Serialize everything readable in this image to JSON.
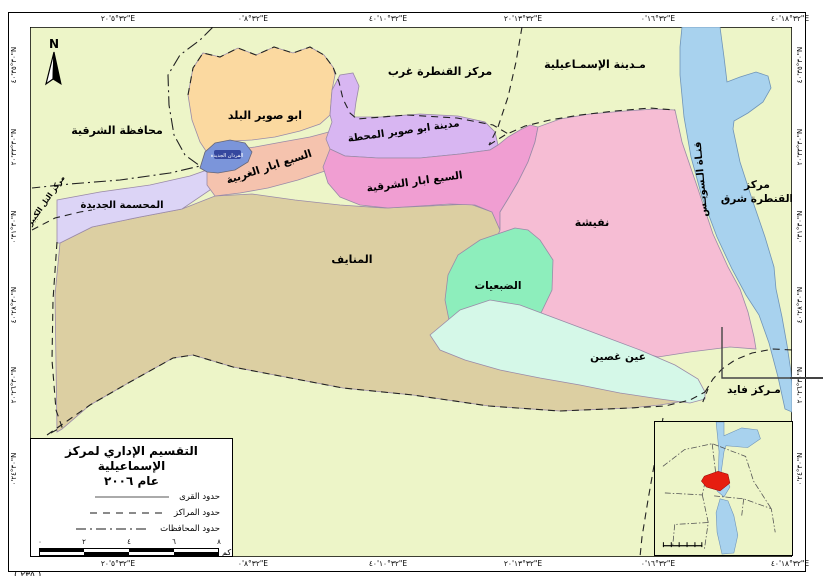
{
  "frame": {
    "north_label": "N",
    "caption_fragment": "( ٢٣٥ )"
  },
  "coords": {
    "lon": [
      "٣٢°٥'٢٠\"E",
      "٣٢°٨'٠\"E",
      "٣٢°١٠'٤٠\"E",
      "٣٢°١٣'٢٠\"E",
      "٣٢°١٦'٠\"E",
      "٣٢°١٨'٤٠\"E"
    ],
    "lat": [
      "٣٠°٣٥'٤٠\"N",
      "٣٠°٣٣'٢٠\"N",
      "٣٠°٣١'٠\"N",
      "٣٠°٢٨'٤٠\"N",
      "٣٠°٢٦'٢٠\"N",
      "٣٠°٢٤'٠\"N"
    ]
  },
  "regions": {
    "abu_suwair_balad": "ابو صوير البلد",
    "abu_suwair_mahatta": "مدينة ابو صوير المحطة",
    "sabaa_abar_gharbia": "السبع ابار الغربية",
    "sabaa_abar_sharqia": "السبع ابار الشرقية",
    "ferdan_gedida": "الفردان الجديدة",
    "mahsama_gedida": "المحسمة الجديدة",
    "manayef": "المنايف",
    "nefisha": "نفيشة",
    "dabaiyat": "الضبعيات",
    "ain_ghosein": "عين غصين",
    "suez_canal": "قنـاة الـسويـس"
  },
  "neighbors": {
    "sharqia_gov": "محافظة الشرقية",
    "qantara_gharb": "مركز القنطرة غرب",
    "ismailia_city": "مـدينة الإسمـاعيلية",
    "qantara_sharq_line1": "مركز",
    "qantara_sharq_line2": "القنطرة شرق",
    "fayed": "مـركز فايد",
    "tell_kebir": "مركز التل الكبير"
  },
  "legend_box": {
    "title_line1": "التقسيم الإداري لمركز الإسماعيلية",
    "title_line2": "عام ٢٠٠٦",
    "items": [
      {
        "label": "حدود القرى",
        "style": "solid"
      },
      {
        "label": "حدود المراكز",
        "style": "dashed"
      },
      {
        "label": "حدود المحافظات",
        "style": "dashdot"
      }
    ],
    "scalebar": {
      "ticks": [
        "٠",
        "٢",
        "٤",
        "٦",
        "٨"
      ],
      "unit": "كم"
    }
  },
  "colors": {
    "map_bg": "#edf5c8",
    "tan": "#dccfa2",
    "lavender": "#dcd4f6",
    "salmon": "#f5c3ae",
    "orange": "#fbd9a0",
    "violet": "#d8b6f2",
    "magenta": "#f09ed2",
    "pink": "#f6bdd4",
    "mint": "#8deebc",
    "pale_mint": "#d5f8e8",
    "blue_region": "#7b95da",
    "water": "#a8d2ee",
    "inset_red": "#e61e10",
    "region_border": "#9a8aa8"
  }
}
